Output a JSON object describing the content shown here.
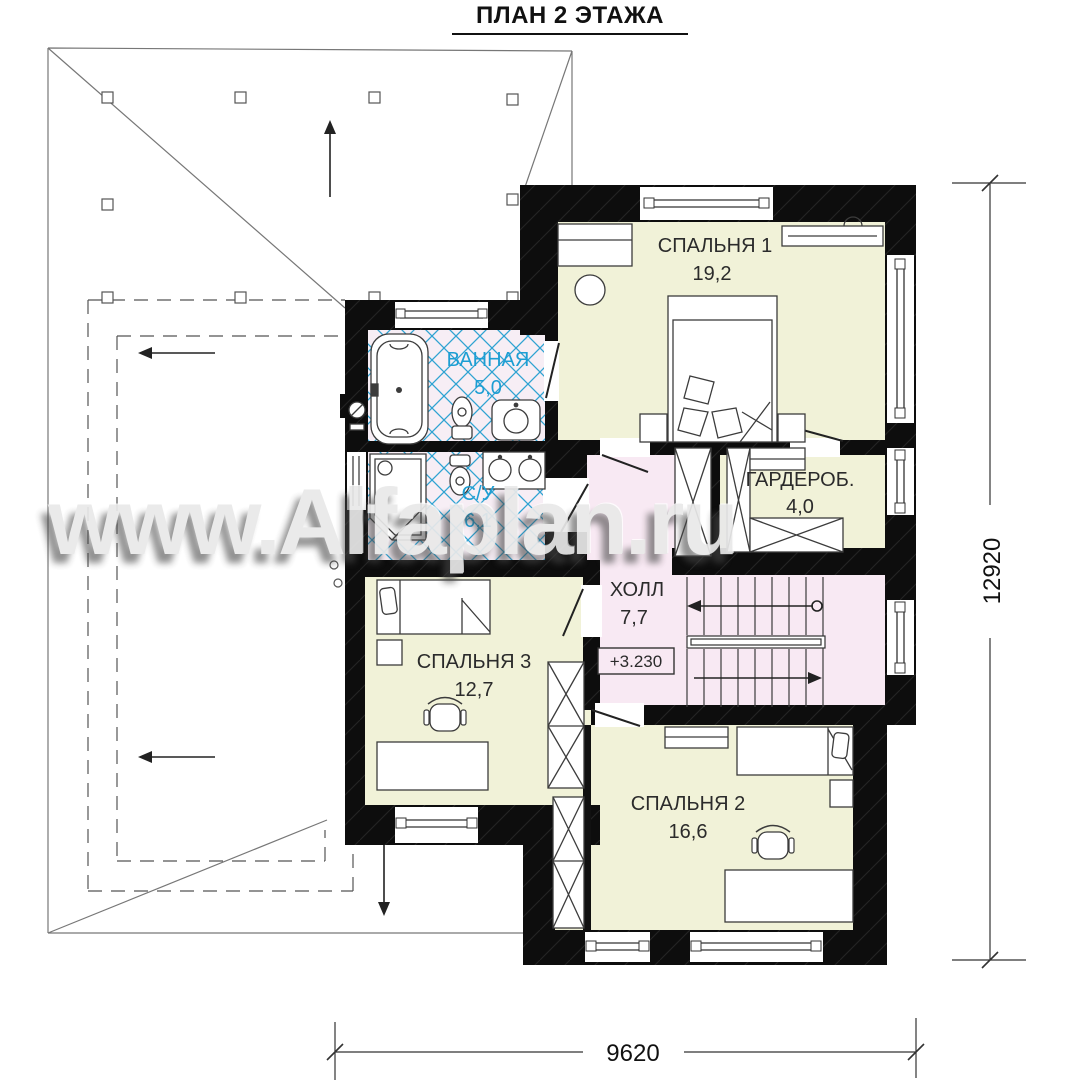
{
  "title": "ПЛАН 2 ЭТАЖА",
  "watermark": "www.Alfaplan.ru",
  "rooms": {
    "bedroom1": {
      "name": "СПАЛЬНЯ 1",
      "area": "19,2"
    },
    "bathroom": {
      "name": "ВАННАЯ",
      "area": "5,0"
    },
    "wc": {
      "name": "С/У",
      "area": "6,1"
    },
    "wardrobe": {
      "name": "ГАРДЕРОБ.",
      "area": "4,0"
    },
    "hall": {
      "name": "ХОЛЛ",
      "area": "7,7"
    },
    "bedroom3": {
      "name": "СПАЛЬНЯ 3",
      "area": "12,7"
    },
    "bedroom2": {
      "name": "СПАЛЬНЯ 2",
      "area": "16,6"
    }
  },
  "level_mark": "+3.230",
  "dimensions": {
    "height_mm": "12920",
    "width_mm": "9620"
  },
  "colors": {
    "room_fill": "#f1f2d8",
    "hall_fill": "#f8e9f3",
    "bath_fill": "#f7eef5",
    "tile_blue": "#2fa3d2",
    "bath_label": "#1d9ed3",
    "wall": "#0d0d0d"
  }
}
